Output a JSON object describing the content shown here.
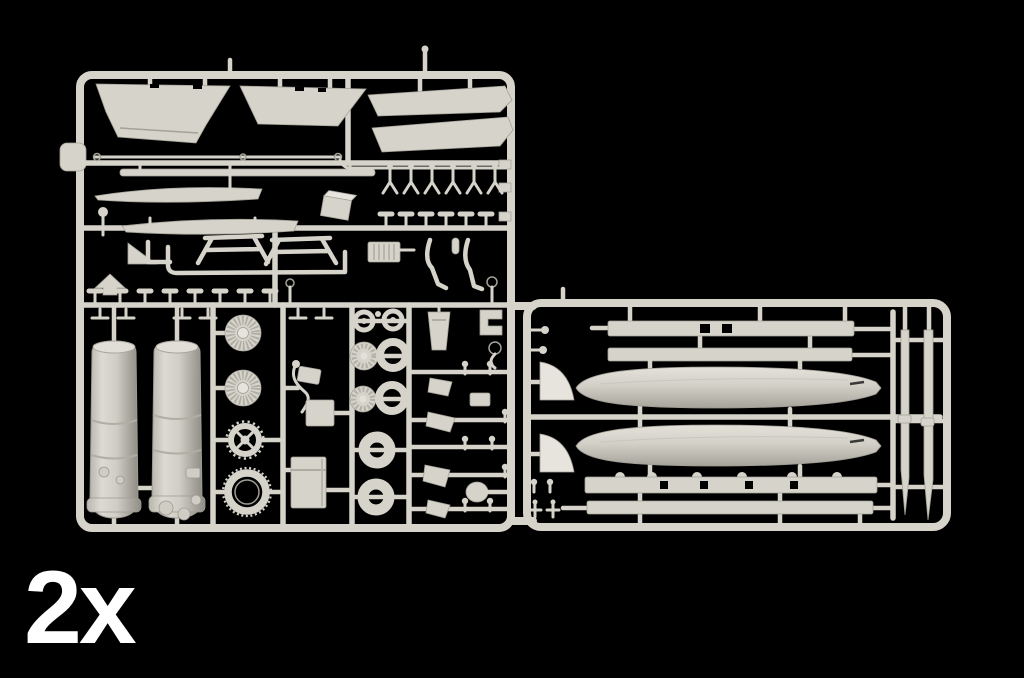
{
  "scene": {
    "type": "product-photo",
    "subject": "injection-molded plastic model kit sprue photographed on a black background",
    "quantity_label": "2x"
  },
  "colors": {
    "background": "#000000",
    "plastic": "#d6d4ca",
    "plastic_light": "#e6e4dc",
    "plastic_mid": "#c6c4bb",
    "plastic_dark": "#a3a198",
    "plastic_deep": "#8d8b83",
    "label_text": "#ffffff"
  },
  "parts_inventory": [
    {
      "name": "wing-flap-panel",
      "count": 2
    },
    {
      "name": "leading-edge-slat",
      "count": 2
    },
    {
      "name": "antenna-probe-rod",
      "count": 2
    },
    {
      "name": "stabilator-blade",
      "count": 2
    },
    {
      "name": "engine-exhaust-nozzle",
      "count": 2
    },
    {
      "name": "turbine-fan-disc",
      "count": 2
    },
    {
      "name": "afterburner-gear-ring",
      "count": 1
    },
    {
      "name": "afterburner-ring",
      "count": 1
    },
    {
      "name": "wheel-hub",
      "count": 4
    },
    {
      "name": "tire",
      "count": 4
    },
    {
      "name": "equipment-box",
      "count": 1
    },
    {
      "name": "landing-gear-strut",
      "count": 1
    },
    {
      "name": "ejection-seat-part",
      "count": 6
    },
    {
      "name": "drop-tank",
      "count": 2
    },
    {
      "name": "pylon-strip",
      "count": 4
    },
    {
      "name": "ventral-fin",
      "count": 2
    },
    {
      "name": "pylon-blade",
      "count": 2
    },
    {
      "name": "small-detail-part",
      "count": 40
    }
  ]
}
